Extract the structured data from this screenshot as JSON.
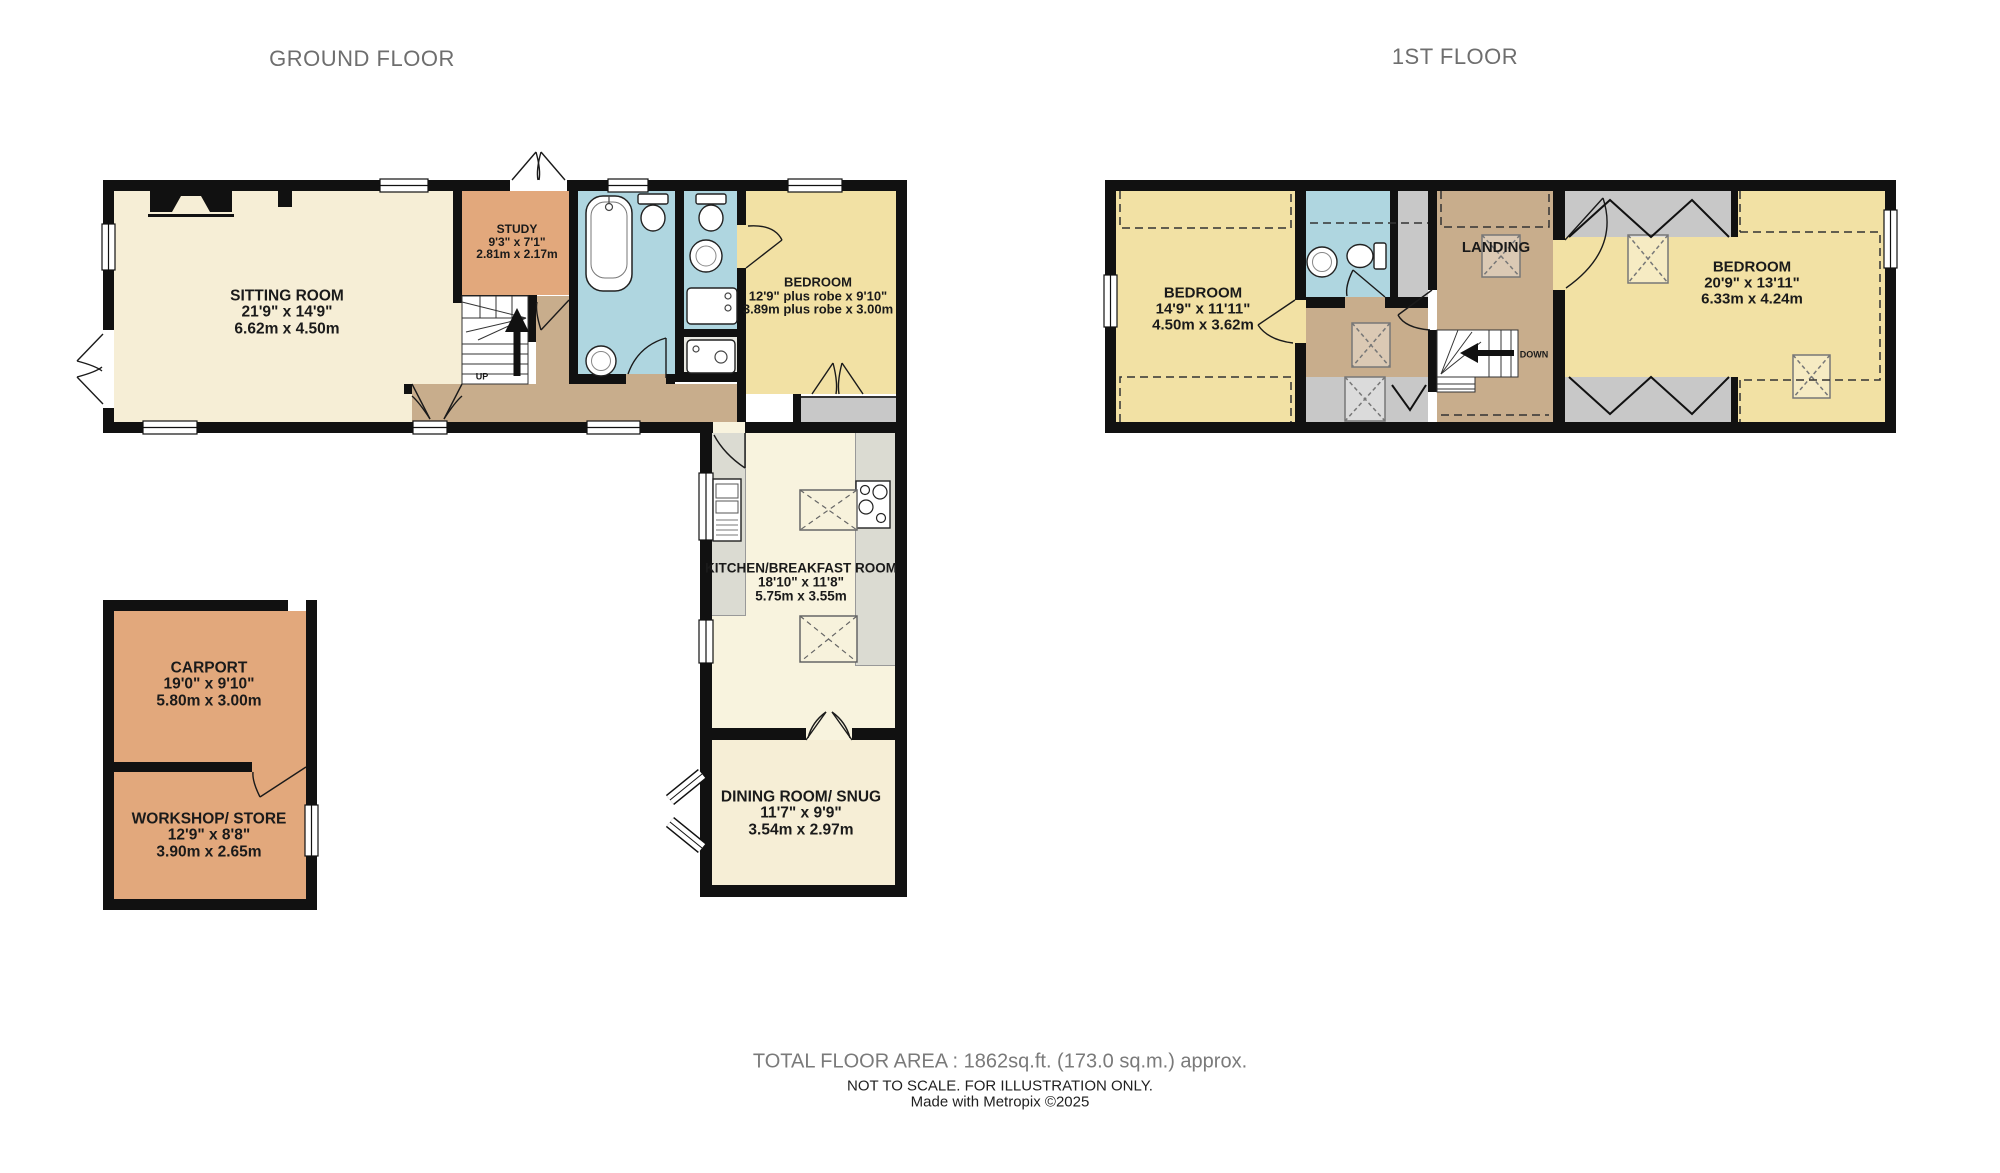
{
  "ground_floor": {
    "title": "GROUND FLOOR",
    "rooms": {
      "sitting_room": {
        "name": "SITTING ROOM",
        "imperial": "21'9\"  x 14'9\"",
        "metric": "6.62m  x 4.50m"
      },
      "study": {
        "name": "STUDY",
        "imperial": "9'3\"  x 7'1\"",
        "metric": "2.81m  x 2.17m"
      },
      "bedroom": {
        "name": "BEDROOM",
        "imperial": "12'9\" plus robe x 9'10\"",
        "metric": "3.89m plus robe x 3.00m"
      },
      "kitchen": {
        "name": "KITCHEN/BREAKFAST ROOM",
        "imperial": "18'10\"  x 11'8\"",
        "metric": "5.75m  x 3.55m"
      },
      "dining": {
        "name": "DINING ROOM/ SNUG",
        "imperial": "11'7\"  x 9'9\"",
        "metric": "3.54m  x 2.97m"
      },
      "carport": {
        "name": "CARPORT",
        "imperial": "19'0\"  x 9'10\"",
        "metric": "5.80m  x 3.00m"
      },
      "workshop": {
        "name": "WORKSHOP/ STORE",
        "imperial": "12'9\"  x 8'8\"",
        "metric": "3.90m  x 2.65m"
      }
    },
    "stairs_up": "UP"
  },
  "first_floor": {
    "title": "1ST FLOOR",
    "rooms": {
      "bedroom_left": {
        "name": "BEDROOM",
        "imperial": "14'9\"  x 11'11\"",
        "metric": "4.50m  x 3.62m"
      },
      "landing": {
        "name": "LANDING"
      },
      "bedroom_right": {
        "name": "BEDROOM",
        "imperial": "20'9\"  x 13'11\"",
        "metric": "6.33m  x 4.24m"
      }
    },
    "stairs_down": "DOWN"
  },
  "footer": {
    "total_area": "TOTAL FLOOR AREA : 1862sq.ft. (173.0 sq.m.) approx.",
    "disclaimer": "NOT TO SCALE. FOR ILLUSTRATION ONLY.",
    "credit": "Made with Metropix ©2025"
  },
  "colors": {
    "wall": "#111111",
    "cream": "#F6EED6",
    "pale_cream": "#F8F3DE",
    "yellow": "#F2E1A4",
    "orange": "#E2A87C",
    "hall_tan": "#C8AD8C",
    "bath_blue": "#AFD6E0",
    "eaves_gray": "#C8C8C8",
    "counter_gray": "#DBDBD2"
  }
}
